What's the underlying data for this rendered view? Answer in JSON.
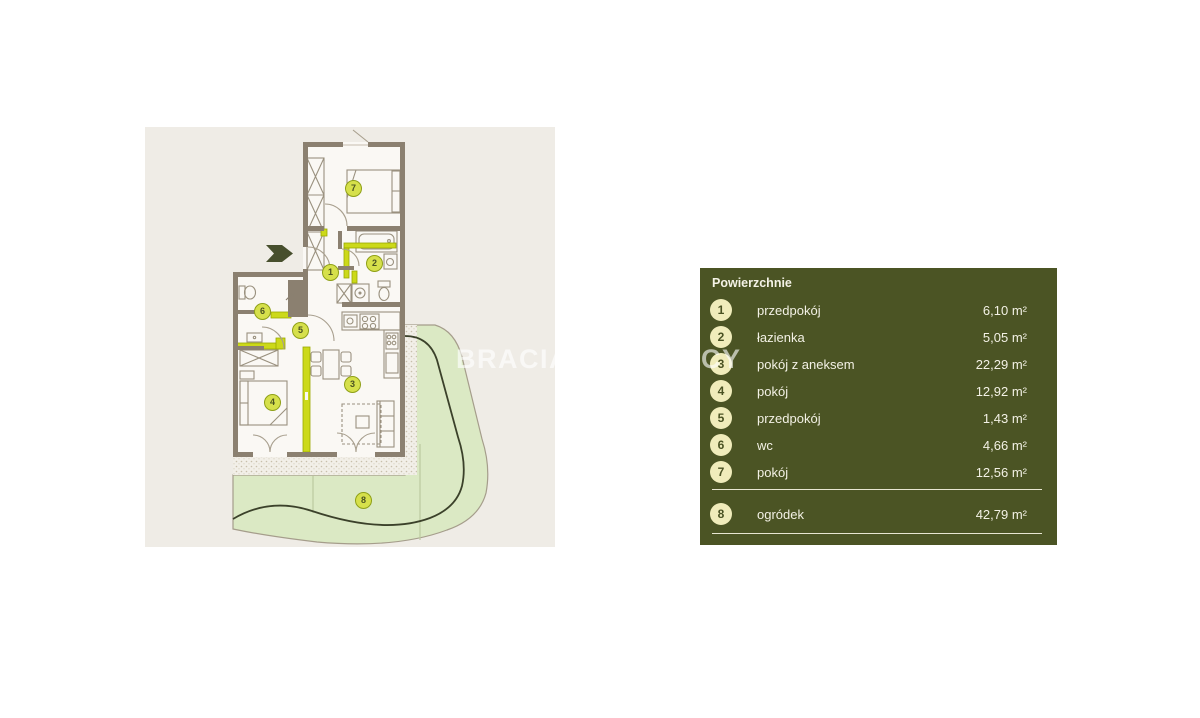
{
  "watermark": "BRACIA SADURSCY",
  "plan": {
    "entry_arrow": "entry-direction-right",
    "badge_numbers": [
      "1",
      "2",
      "3",
      "4",
      "5",
      "6",
      "7",
      "8"
    ]
  },
  "legend": {
    "title": "Powierzchnie",
    "rows": [
      {
        "num": "1",
        "label": "przedpokój",
        "value": "6,10 m²"
      },
      {
        "num": "2",
        "label": "łazienka",
        "value": "5,05 m²"
      },
      {
        "num": "3",
        "label": "pokój z aneksem",
        "value": "22,29 m²"
      },
      {
        "num": "4",
        "label": "pokój",
        "value": "12,92 m²"
      },
      {
        "num": "5",
        "label": "przedpokój",
        "value": "1,43 m²"
      },
      {
        "num": "6",
        "label": "wc",
        "value": "4,66 m²"
      },
      {
        "num": "7",
        "label": "pokój",
        "value": "12,56 m²"
      },
      {
        "num": "8",
        "label": "ogródek",
        "value": "42,79 m²"
      }
    ]
  },
  "colors": {
    "page_bg": "#ffffff",
    "plan_bg": "#efece6",
    "wall": "#8b8070",
    "room_fill": "#faf8f4",
    "highlight_yellow": "#ccd919",
    "badge_fill": "#d6e04b",
    "garden_green": "#dbe9c4",
    "garden_curve": "#3b412a",
    "legend_bg": "#4b5424",
    "legend_circle": "#f0ecbb",
    "legend_text": "#f3f1e5"
  }
}
